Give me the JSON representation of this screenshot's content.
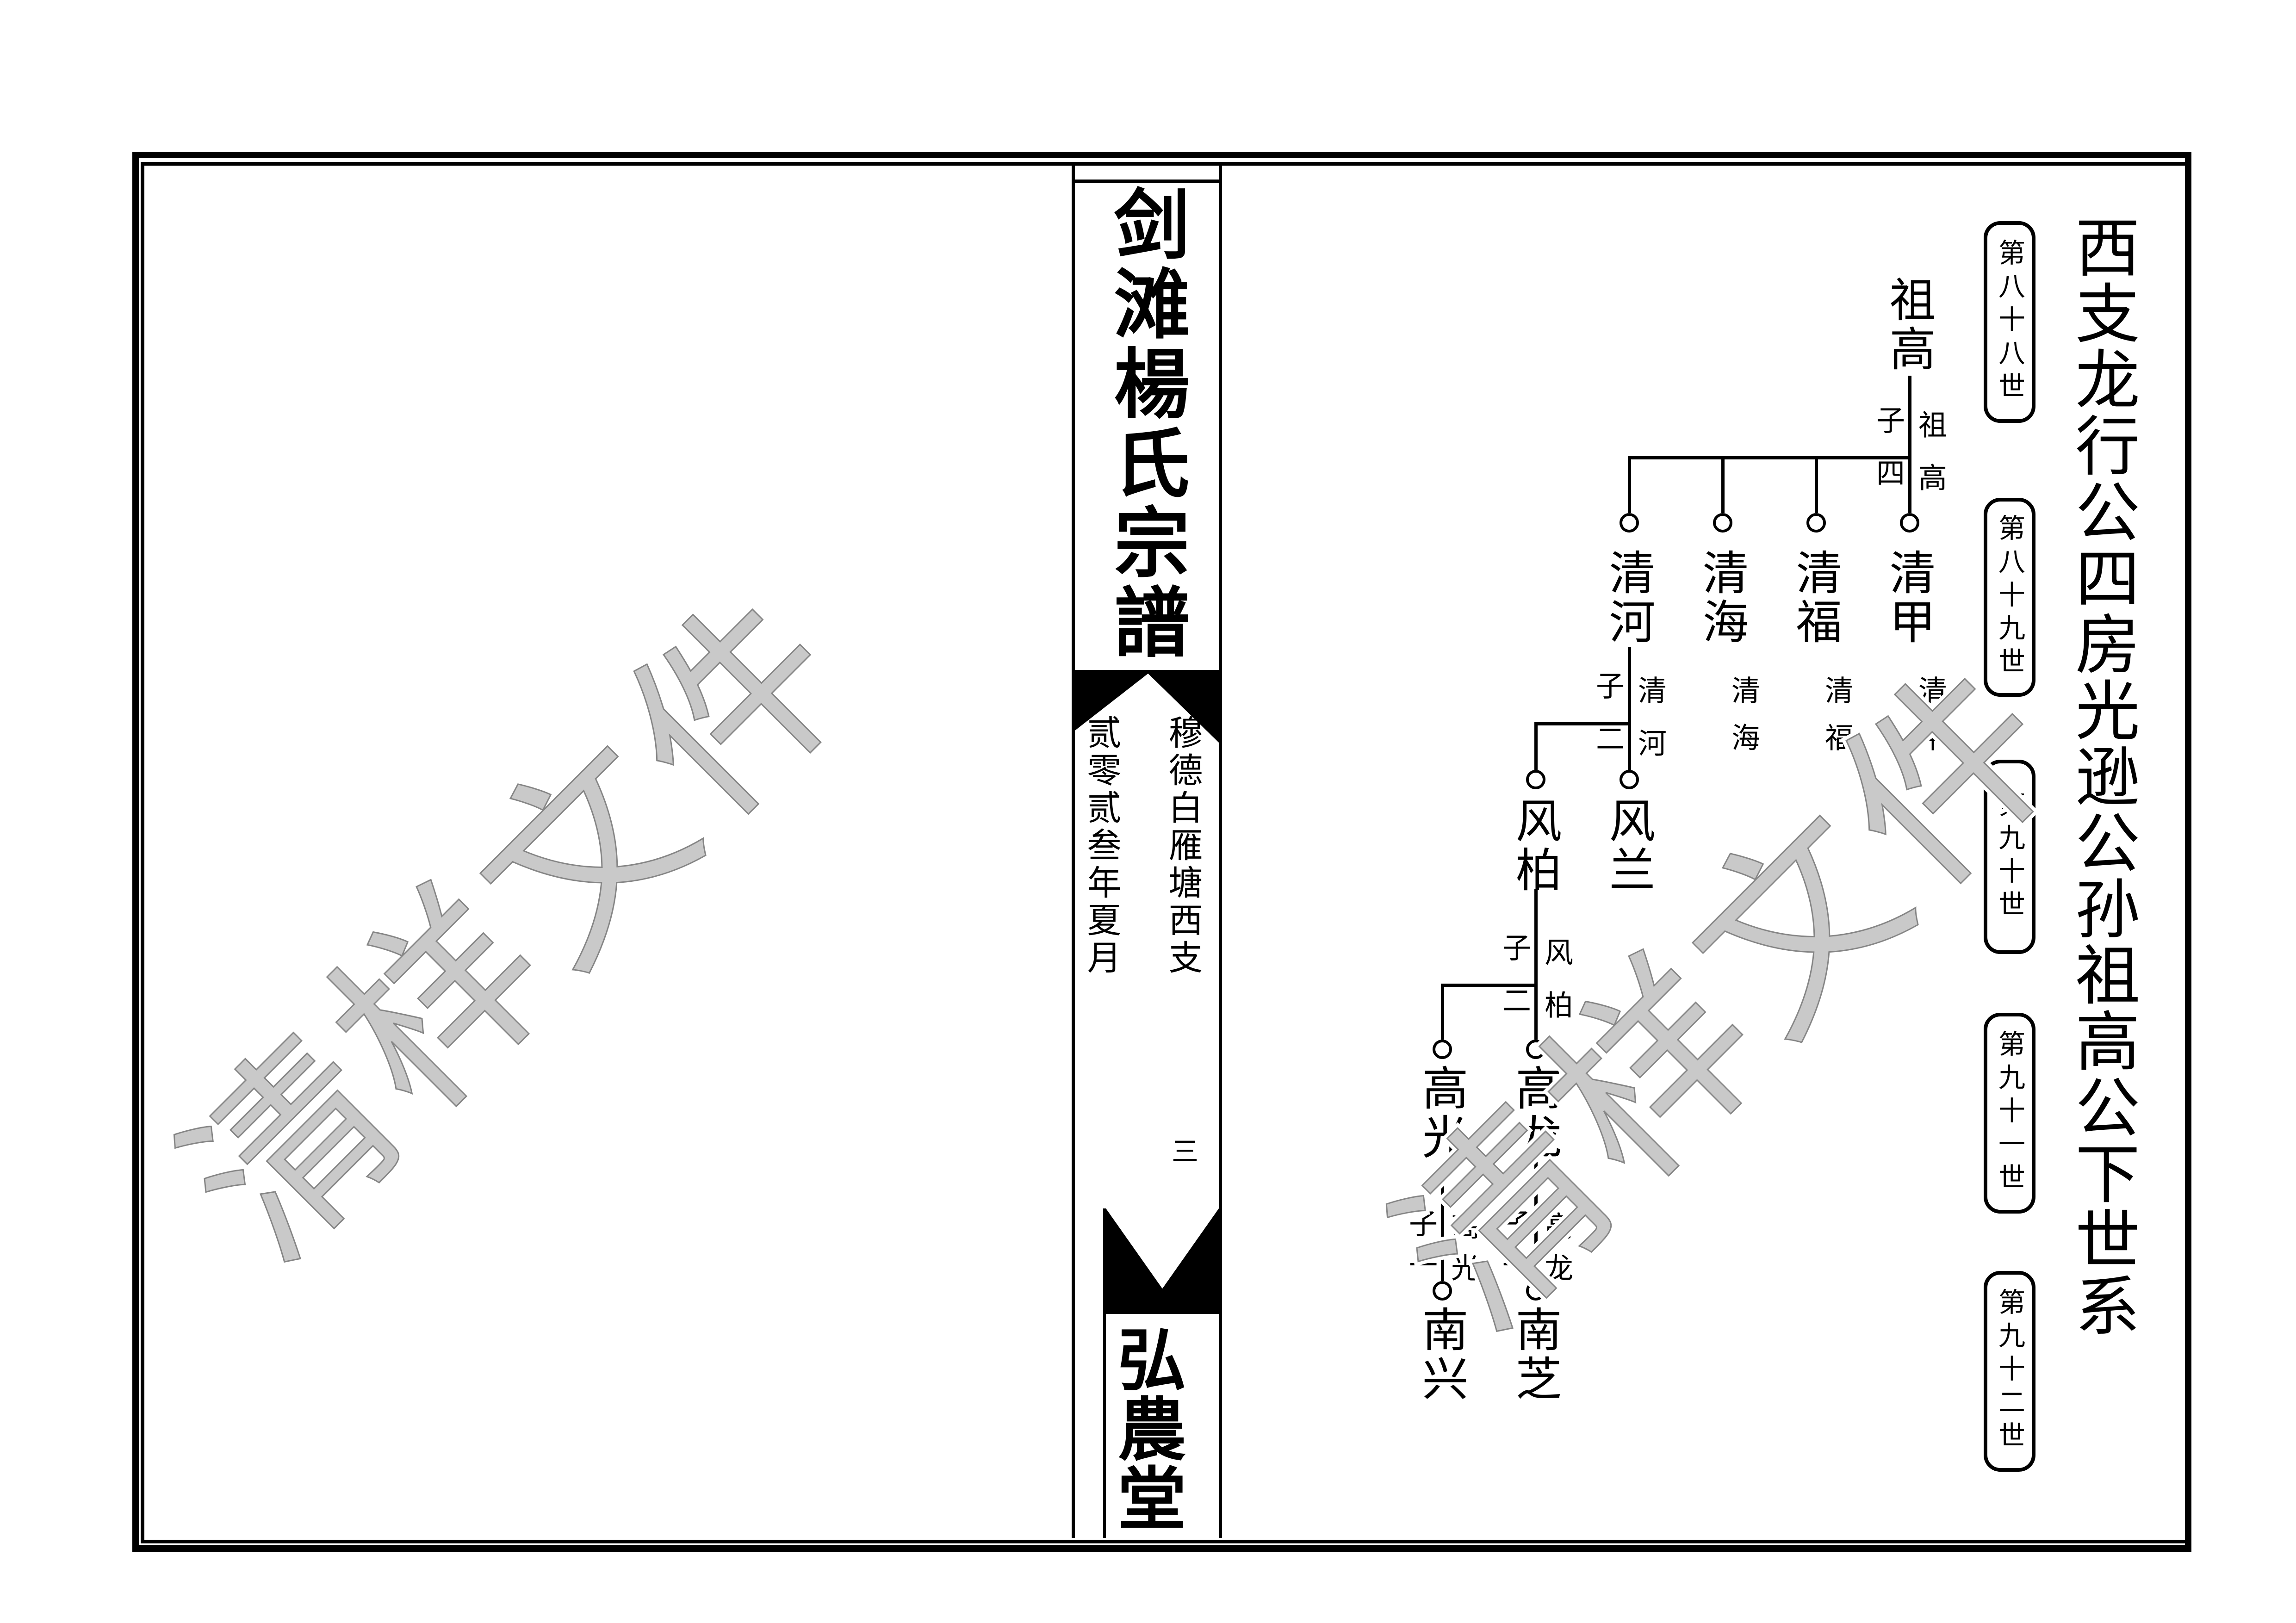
{
  "page": {
    "side_title": "西支龙行公四房光逊公孙祖高公下世系",
    "generation_labels": [
      "第八十八世",
      "第八十九世",
      "第九十世",
      "第九十一世",
      "第九十二世"
    ],
    "watermark_text": "清样文件",
    "spine": {
      "book_title": "剑滩楊氏宗譜",
      "branch_note": "穆德白雁塘西支",
      "date_note": "贰零贰叁年夏月",
      "volume_number": "三",
      "hall_name": "弘農堂"
    },
    "tree": {
      "ancestor": "祖高",
      "level1": {
        "children_label": "子四",
        "parent_label": "祖高",
        "names": [
          "清河",
          "清海",
          "清福",
          "清甲"
        ],
        "continuation_labels": [
          "清海",
          "清福",
          "清甲"
        ]
      },
      "level2": {
        "children_label": "子二",
        "parent_label": "清河",
        "names": [
          "风柏",
          "风兰"
        ]
      },
      "level3": {
        "children_label": "子二",
        "parent_label": "风柏",
        "names": [
          "高光",
          "高龙"
        ]
      },
      "level4": [
        {
          "children_label": "子一",
          "parent_label": "高光",
          "name": "南兴"
        },
        {
          "children_label": "子一",
          "parent_label": "高龙",
          "name": "南芝"
        }
      ]
    }
  }
}
